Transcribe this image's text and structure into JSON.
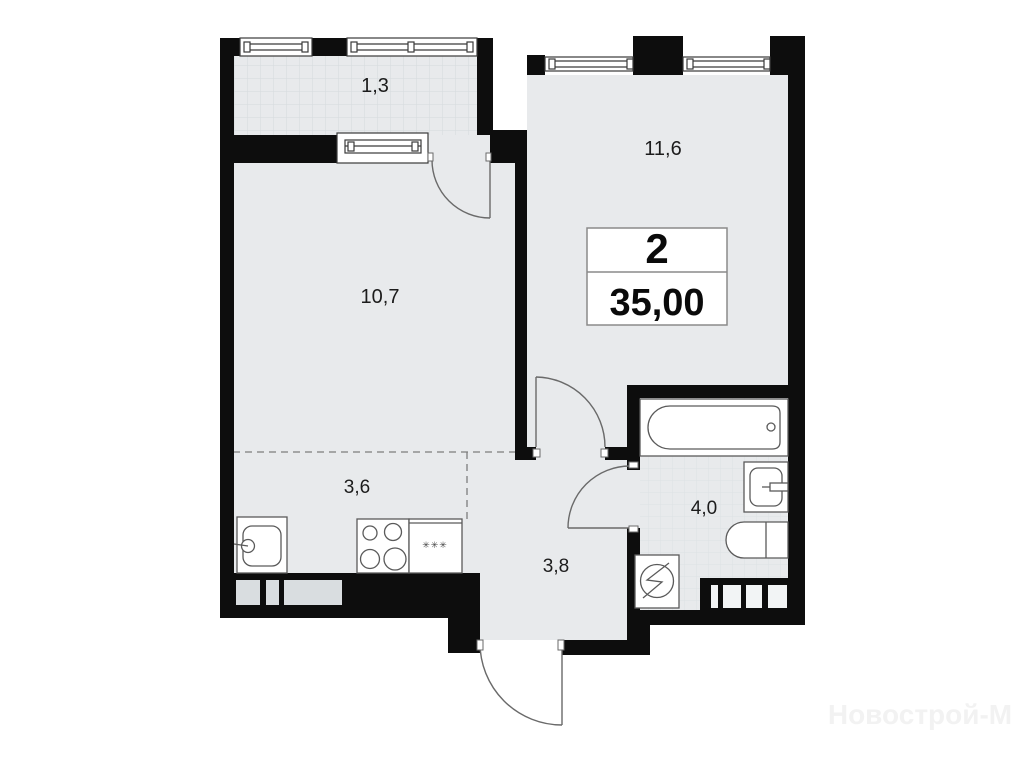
{
  "plan": {
    "type": "apartment-floorplan",
    "info_box": {
      "rooms_count": "2",
      "total_area": "35,00"
    },
    "rooms": [
      {
        "id": "balcony",
        "label": "1,3"
      },
      {
        "id": "bedroom",
        "label": "11,6"
      },
      {
        "id": "living-room",
        "label": "10,7"
      },
      {
        "id": "kitchen",
        "label": "3,6"
      },
      {
        "id": "hallway",
        "label": "3,8"
      },
      {
        "id": "bathroom",
        "label": "4,0"
      }
    ],
    "symbols": {
      "kitchen_cabinet_marks": "✳✳✳"
    },
    "watermark": "Новострой-М",
    "colors": {
      "wall": "#0d0d0d",
      "floor": "#e8eaec",
      "tile_line": "#d5dadd",
      "background": "#ffffff"
    }
  }
}
